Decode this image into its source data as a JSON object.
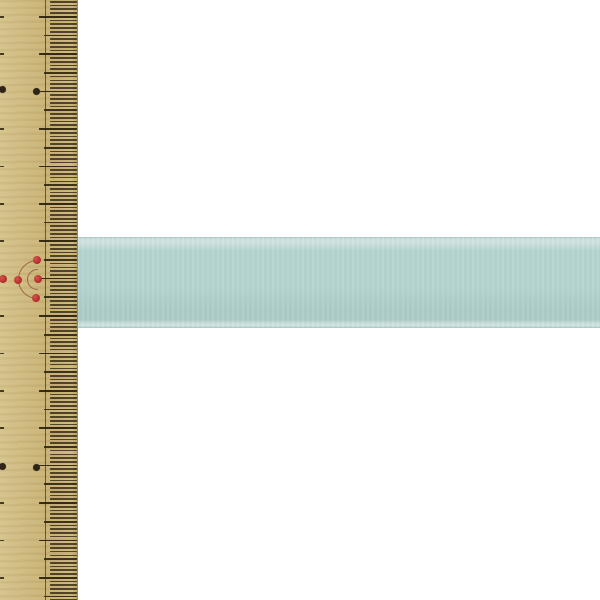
{
  "scene": {
    "description": "Pale aqua satin ribbon laid horizontally across a bamboo sewing ruler on a white background",
    "canvas": {
      "width": 600,
      "height": 600
    }
  },
  "colors": {
    "page_bg": "#ffffff",
    "ruler_base": "#cdb87d",
    "ruler_light": "#d5c38b",
    "ruler_dark": "#c6af71",
    "tick": "#2e2310",
    "scale_line": "#4a3a1d",
    "black_dot": "#2f2416",
    "red_dot": "#b6302c",
    "mark_line": "#8a4a35",
    "ribbon_body": "#b5d3d0",
    "ribbon_shade": "#adccc8",
    "ribbon_edge_light": "#cfe2df",
    "ribbon_edge_line": "#a2c7c3"
  },
  "ruler": {
    "width_px": 78,
    "scale_line_x": 45,
    "first_major_y": 16.8,
    "major_spacing": 37.4,
    "minor_per_major": 10,
    "tick_lengths": {
      "fine": 27,
      "medium": 33,
      "major": 38,
      "edge_stub": 4
    },
    "tick_thickness": 1.7,
    "black_dot_size": 7,
    "red_dot_size": 8,
    "black_dots": [
      [
        2.5,
        89.5
      ],
      [
        36.5,
        91.5
      ],
      [
        2.5,
        466.5
      ],
      [
        36.5,
        467.5
      ]
    ],
    "red_dots": [
      [
        37,
        260
      ],
      [
        37.5,
        279
      ],
      [
        35.5,
        298
      ],
      [
        18,
        279.5
      ],
      [
        2.5,
        278.5
      ]
    ],
    "arc_center": [
      37.5,
      279
    ],
    "arc_radii": [
      10.5,
      19.5
    ]
  },
  "ribbon": {
    "top_y": 237,
    "height": 91,
    "left_x": 77
  }
}
